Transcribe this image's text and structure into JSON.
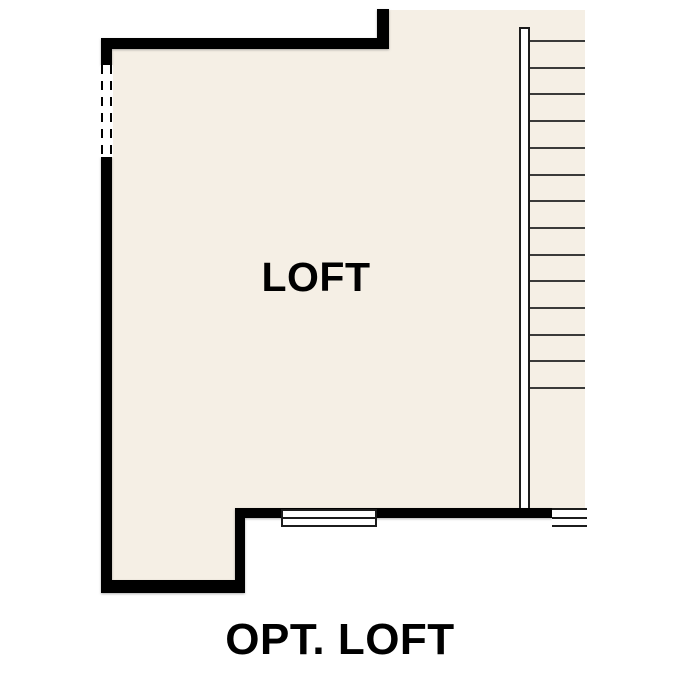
{
  "plan": {
    "room_label": "LOFT",
    "caption": "OPT. LOFT",
    "colors": {
      "background": "#ffffff",
      "floor": "#f5efe5",
      "wall": "#000000",
      "stair_line": "#3a3a3a",
      "fixture_outline": "#1c1c1c",
      "fixture_fill": "#ffffff",
      "label_text": "#000000"
    },
    "stairs": {
      "step_count": 14,
      "first_step_y": 40,
      "step_spacing": 26.7,
      "x": 530,
      "width": 55
    }
  }
}
